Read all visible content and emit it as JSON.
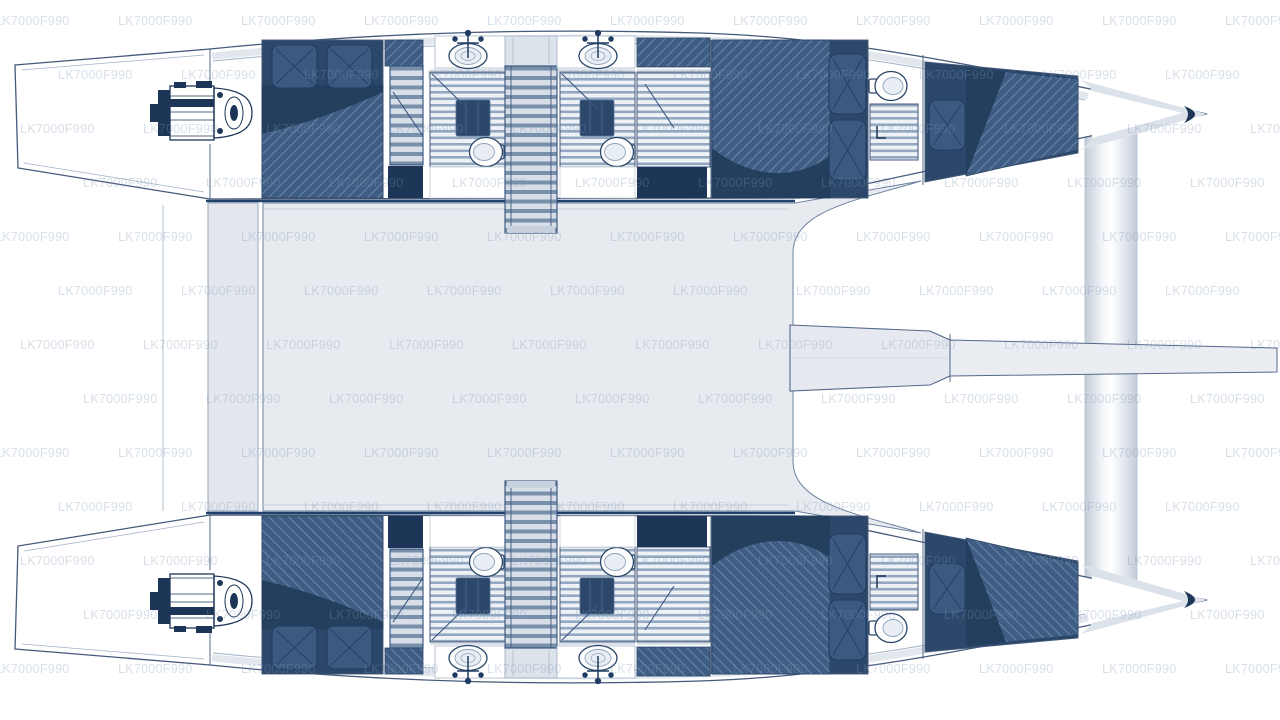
{
  "diagram": {
    "type": "floorplan",
    "subject": "Catamaran deck and accommodation plan, top view, bows to the right",
    "watermark": {
      "text": "LK7000F990"
    },
    "colors": {
      "outline": "#44597b",
      "navy": "#2c4769",
      "navy_dark": "#1d3658",
      "navy_fold": "#243f5e",
      "deck": "#e7ebf0",
      "walkway": "#e4e8ee",
      "deck_border": "#21406b",
      "hatch_base": "#3f5c82",
      "hatch_line": "#6684a8",
      "slat_light": "#eef2f7",
      "slat_dark": "#93a8c0",
      "stair_light": "#d7dee8",
      "stair_dark": "#7990ab",
      "rim": "#e2e7ee",
      "watermark": "#7e96b8"
    },
    "structure": {
      "hulls": [
        {
          "name": "port hull (top)",
          "features": [
            "transom steps",
            "engine",
            "aft double cabin with two pillows",
            "aft companionway stairs",
            "head with shower, sink and toilet",
            "central companionway stairs",
            "second head with shower, sink and toilet",
            "slatted corridor",
            "forward double cabin with two pillows",
            "forward head with toilet and shower ladder",
            "bow single berth",
            "bow deck"
          ]
        },
        {
          "name": "starboard hull (bottom)",
          "features": [
            "transom steps",
            "engine",
            "aft double cabin with two pillows",
            "aft companionway stairs",
            "head with shower, sink and toilet",
            "central companionway stairs",
            "second head with shower, sink and toilet",
            "slatted corridor",
            "forward double cabin with two pillows",
            "forward head with toilet and shower ladder",
            "bow single berth",
            "bow deck"
          ]
        }
      ],
      "shared": [
        "bridge deck saloon area",
        "aft walkway crossbeam",
        "forward trampoline area",
        "forward vertical crossbeam",
        "bowsprit boom extending to the right"
      ]
    }
  }
}
